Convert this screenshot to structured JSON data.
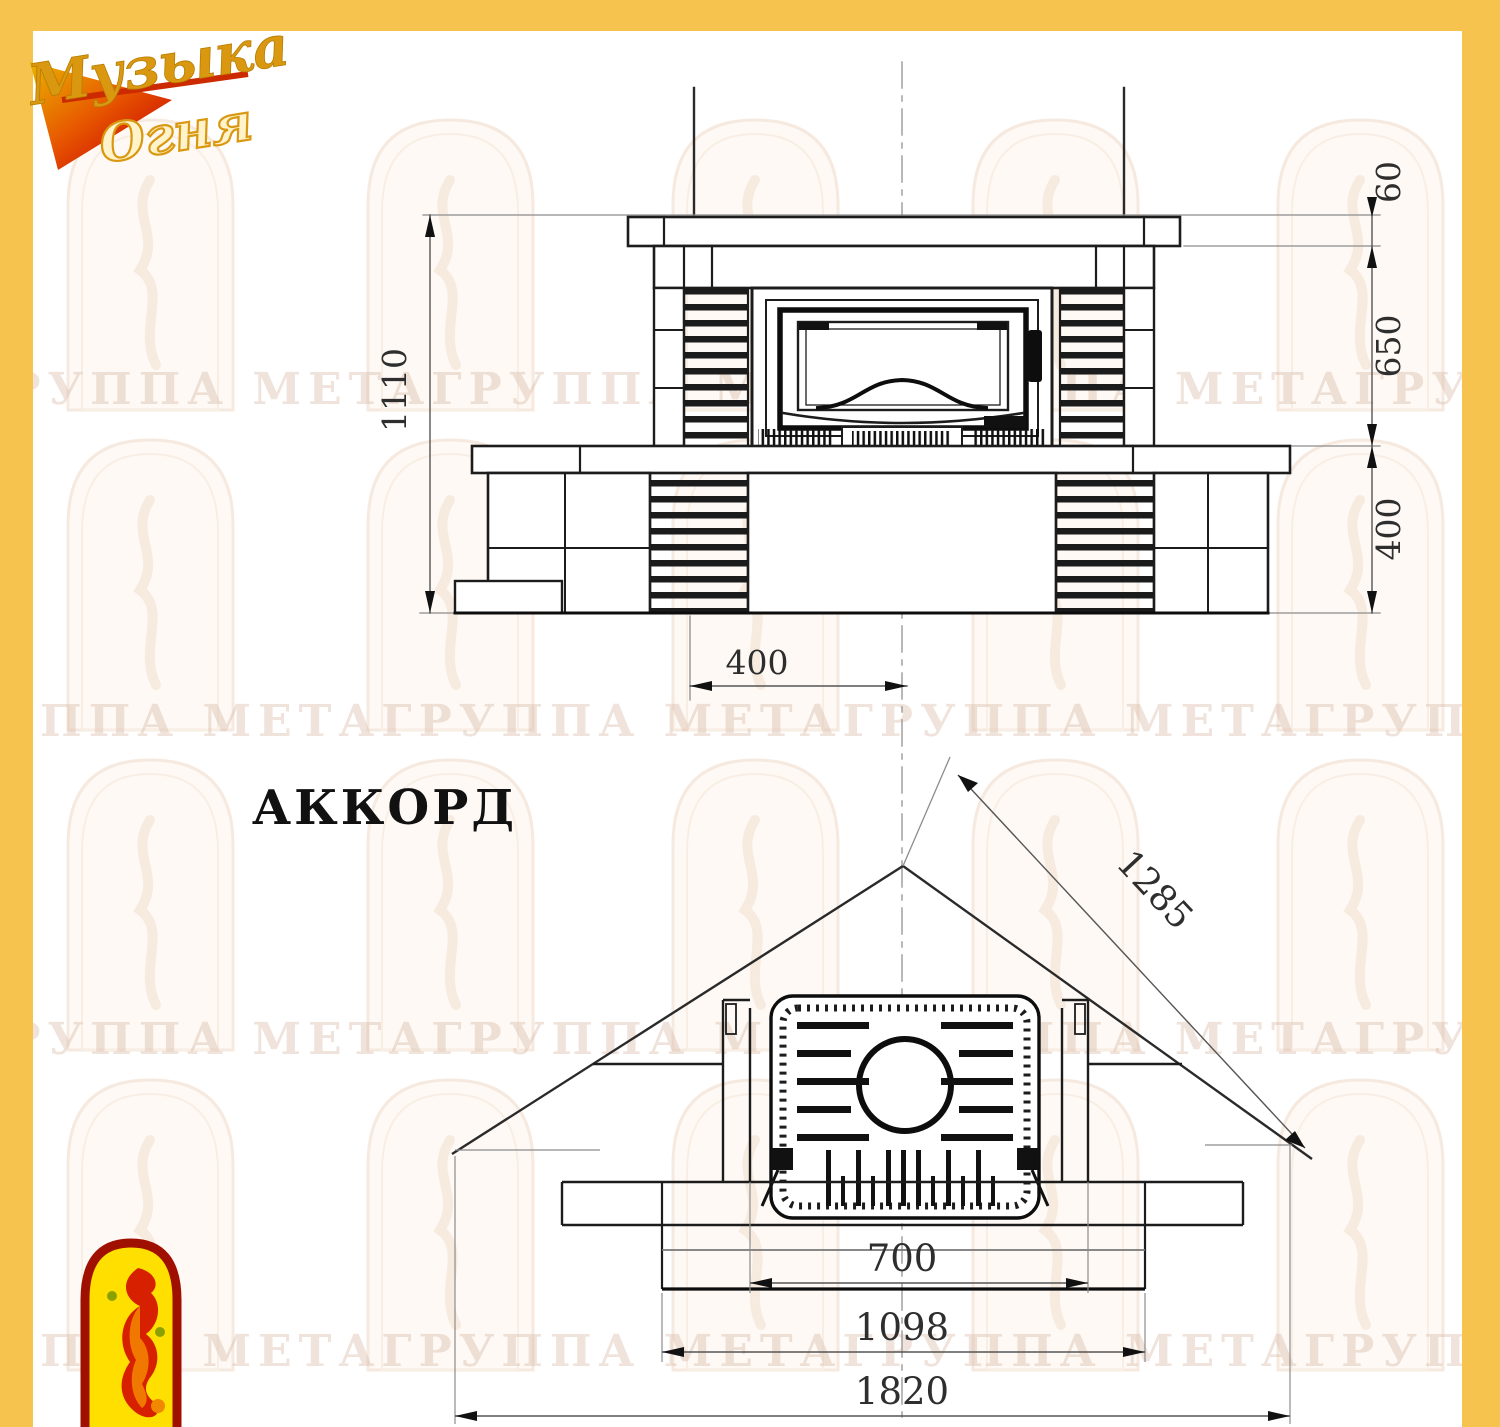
{
  "logo": {
    "line1": "Музыка",
    "line2": "Огня"
  },
  "title": "АККОРД",
  "watermark": {
    "text": "ГРУППА МЕТАГРУППА МЕТАГРУППА МЕТАГРУППА МЕТА"
  },
  "colors": {
    "accent": "#f6c44e",
    "line": "#1c1c1c",
    "dim_text": "#2e2e2e"
  },
  "front_view": {
    "dims": {
      "total_height": "1110",
      "shelf_thickness": "60",
      "opening_height": "650",
      "base_height": "400",
      "pedestal_width": "400"
    }
  },
  "plan_view": {
    "dims": {
      "wall_side": "1285",
      "firebox_opening": "700",
      "hearth_width": "1098",
      "total_width": "1820"
    }
  }
}
